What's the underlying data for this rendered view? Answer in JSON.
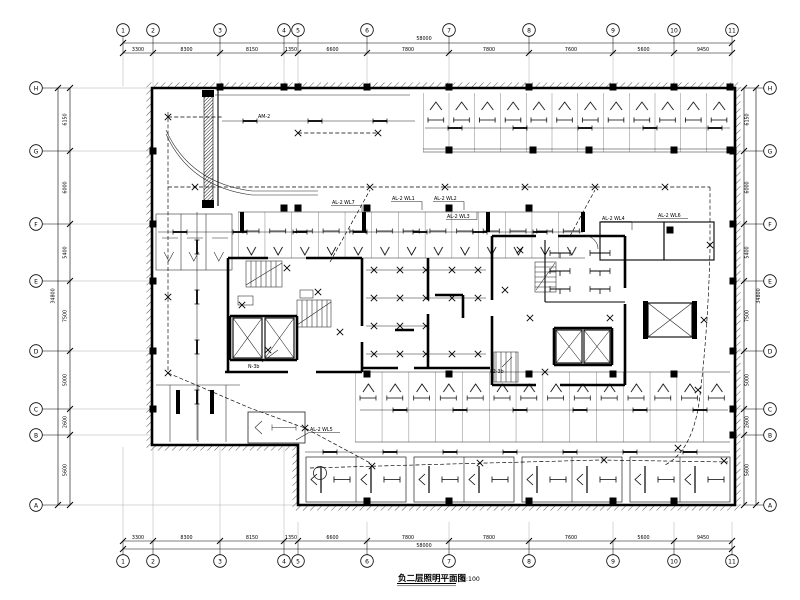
{
  "sheet": {
    "kind": "electrical lighting floor plan drawing"
  },
  "title": {
    "name": "负二层照明平面图",
    "scale": "1:100"
  },
  "axes": {
    "cols": {
      "labels": [
        "1",
        "2",
        "3",
        "4",
        "5",
        "6",
        "7",
        "8",
        "9",
        "10",
        "11"
      ],
      "dims": [
        "3300",
        "8300",
        "8150",
        "1350",
        "6600",
        "7800",
        "7800",
        "7600",
        "5600",
        "9450"
      ],
      "total": "58000"
    },
    "rows": {
      "labels": [
        "H",
        "G",
        "F",
        "E",
        "D",
        "C",
        "B",
        "A"
      ],
      "dims": [
        "6150",
        "6000",
        "5400",
        "7500",
        "5000",
        "2600",
        "5600"
      ],
      "total": "34800"
    }
  },
  "labels": {
    "am2": "AM-2",
    "wl1": "AL-2 WL1",
    "wl2": "AL-2 WL2",
    "wl3": "AL-2 WL3",
    "wl4": "AL-2 WL4",
    "wl5": "AL-2 WL5",
    "wl6": "AL-2 WL6",
    "wl7": "AL-2 WL7",
    "n3b": "N-3b",
    "f23b": "F2-3b"
  }
}
